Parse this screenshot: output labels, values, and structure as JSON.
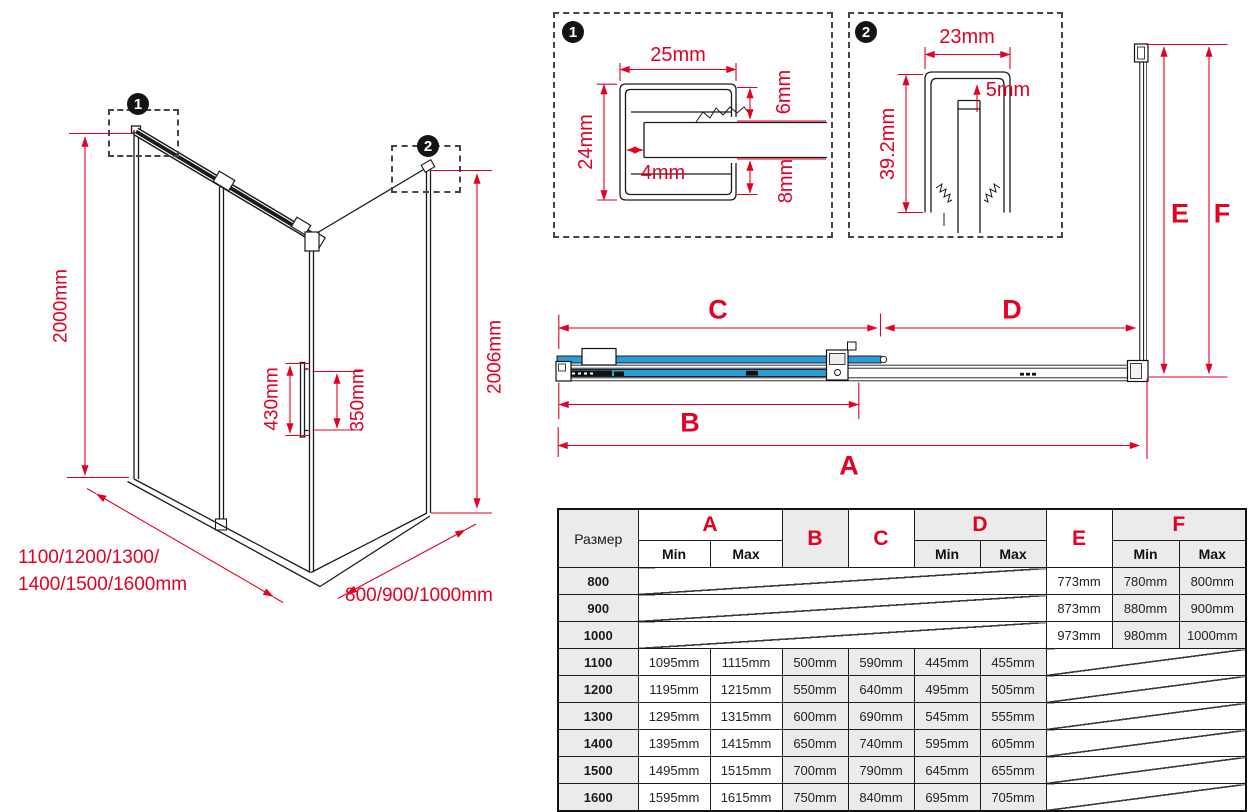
{
  "colors": {
    "accent_red": "#e30022",
    "glass_blue": "#2b9cd8"
  },
  "markers": {
    "one": "1",
    "two": "2"
  },
  "iso": {
    "height_left": "2000mm",
    "height_right": "2006mm",
    "handle_outer": "430mm",
    "handle_inner": "350mm",
    "width_line1": "1100/1200/1300/",
    "width_line2": "1400/1500/1600mm",
    "depth": "800/900/1000mm"
  },
  "detail1": {
    "width": "25mm",
    "height": "24mm",
    "glass_inset": "4mm",
    "top_gap": "6mm",
    "bottom_gap": "8mm"
  },
  "detail2": {
    "width": "23mm",
    "gap": "5mm",
    "height": "39.2mm"
  },
  "plan": {
    "labels": {
      "A": "A",
      "B": "B",
      "C": "C",
      "D": "D",
      "E": "E",
      "F": "F"
    }
  },
  "table": {
    "size_header": "Размер",
    "groups": [
      {
        "label": "A",
        "sub": [
          "Min",
          "Max"
        ],
        "header_shaded": false
      },
      {
        "label": "B",
        "sub": [],
        "header_shaded": true
      },
      {
        "label": "C",
        "sub": [],
        "header_shaded": false
      },
      {
        "label": "D",
        "sub": [
          "Min",
          "Max"
        ],
        "header_shaded": true
      },
      {
        "label": "E",
        "sub": [],
        "header_shaded": false
      },
      {
        "label": "F",
        "sub": [
          "Min",
          "Max"
        ],
        "header_shaded": true
      }
    ],
    "body_shaded_columns": [
      2,
      3,
      4,
      5,
      7,
      8
    ],
    "col_widths": [
      80,
      72,
      72,
      66,
      66,
      66,
      66,
      66,
      67,
      67
    ],
    "rows": [
      {
        "size": "800",
        "values": [
          null,
          null,
          null,
          null,
          null,
          null,
          "773mm",
          "780mm",
          "800mm"
        ]
      },
      {
        "size": "900",
        "values": [
          null,
          null,
          null,
          null,
          null,
          null,
          "873mm",
          "880mm",
          "900mm"
        ]
      },
      {
        "size": "1000",
        "values": [
          null,
          null,
          null,
          null,
          null,
          null,
          "973mm",
          "980mm",
          "1000mm"
        ]
      },
      {
        "size": "1100",
        "values": [
          "1095mm",
          "1115mm",
          "500mm",
          "590mm",
          "445mm",
          "455mm",
          null,
          null,
          null
        ]
      },
      {
        "size": "1200",
        "values": [
          "1195mm",
          "1215mm",
          "550mm",
          "640mm",
          "495mm",
          "505mm",
          null,
          null,
          null
        ]
      },
      {
        "size": "1300",
        "values": [
          "1295mm",
          "1315mm",
          "600mm",
          "690mm",
          "545mm",
          "555mm",
          null,
          null,
          null
        ]
      },
      {
        "size": "1400",
        "values": [
          "1395mm",
          "1415mm",
          "650mm",
          "740mm",
          "595mm",
          "605mm",
          null,
          null,
          null
        ]
      },
      {
        "size": "1500",
        "values": [
          "1495mm",
          "1515mm",
          "700mm",
          "790mm",
          "645mm",
          "655mm",
          null,
          null,
          null
        ]
      },
      {
        "size": "1600",
        "values": [
          "1595mm",
          "1615mm",
          "750mm",
          "840mm",
          "695mm",
          "705mm",
          null,
          null,
          null
        ]
      }
    ]
  }
}
